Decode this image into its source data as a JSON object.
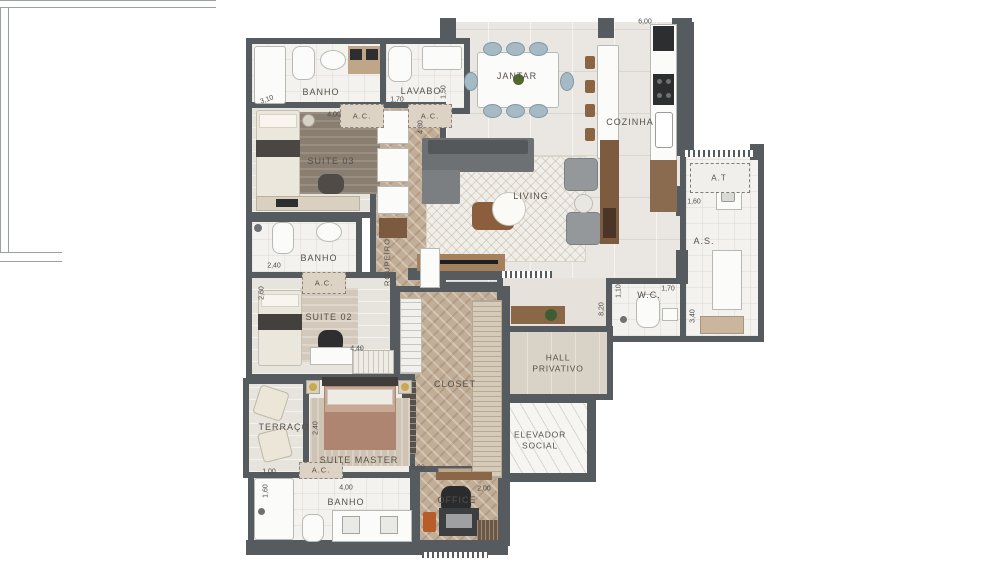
{
  "plan_type": "apartment-floor-plan",
  "colors": {
    "background": "#ffffff",
    "wall": "#565b5f",
    "wood_floor": "#c2ad97",
    "tile_floor": "#eae7e2",
    "hall_floor": "#d9d2c6",
    "rug": "#f1eee8",
    "sofa": "#6d7174",
    "dining_chair": "#a6bac5",
    "wood_furniture": "#8a6747",
    "accent_orange": "#bf6030",
    "label_text": "#565049"
  },
  "rooms": {
    "jantar": {
      "label": "JANTAR"
    },
    "cozinha": {
      "label": "COZINHA"
    },
    "living": {
      "label": "LIVING"
    },
    "banho_1": {
      "label": "BANHO"
    },
    "lavabo": {
      "label": "LAVABO"
    },
    "suite_03": {
      "label": "SUITE 03"
    },
    "roupeiro": {
      "label": "ROUPEIRO"
    },
    "banho_2": {
      "label": "BANHO"
    },
    "suite_02": {
      "label": "SUITE 02"
    },
    "closet": {
      "label": "CLOSET"
    },
    "terraco": {
      "label": "TERRAÇO"
    },
    "suite_master": {
      "label": "SUITE MASTER"
    },
    "banho_master": {
      "label": "BANHO"
    },
    "office": {
      "label": "OFFICE"
    },
    "hall_privativo": {
      "line1": "HALL",
      "line2": "PRIVATIVO"
    },
    "elevador_social": {
      "line1": "ELEVADOR",
      "line2": "SOCIAL"
    },
    "wc": {
      "label": "W.C."
    },
    "as": {
      "label": "A.S."
    },
    "at": {
      "label": "A.T"
    },
    "ac": {
      "label": "A.C."
    }
  },
  "dims": [
    {
      "text": "3,10",
      "area": "banho-suite-03"
    },
    {
      "text": "1,70",
      "area": "lavabo"
    },
    {
      "text": "4,00",
      "area": "suite-03"
    },
    {
      "text": "4,30",
      "area": "roupeiro-corridor"
    },
    {
      "text": "1,50",
      "area": "lavabo-depth"
    },
    {
      "text": "6,00",
      "area": "cozinha"
    },
    {
      "text": "2,40",
      "area": "banho-suite-02"
    },
    {
      "text": "2,60",
      "area": "suite-02-width"
    },
    {
      "text": "4,40",
      "area": "suite-02-length"
    },
    {
      "text": "1,00",
      "area": "terraco"
    },
    {
      "text": "2,40",
      "area": "suite-master-width"
    },
    {
      "text": "5,00",
      "area": "suite-master-length"
    },
    {
      "text": "1,60",
      "area": "banho-master-width"
    },
    {
      "text": "4,00",
      "area": "banho-master-length"
    },
    {
      "text": "2,00",
      "area": "office"
    },
    {
      "text": "8,20",
      "area": "hall-corridor"
    },
    {
      "text": "1,10",
      "area": "wc-width"
    },
    {
      "text": "1,70",
      "area": "wc-length"
    },
    {
      "text": "3,40",
      "area": "as-length"
    },
    {
      "text": "1,60",
      "area": "as-width"
    }
  ]
}
